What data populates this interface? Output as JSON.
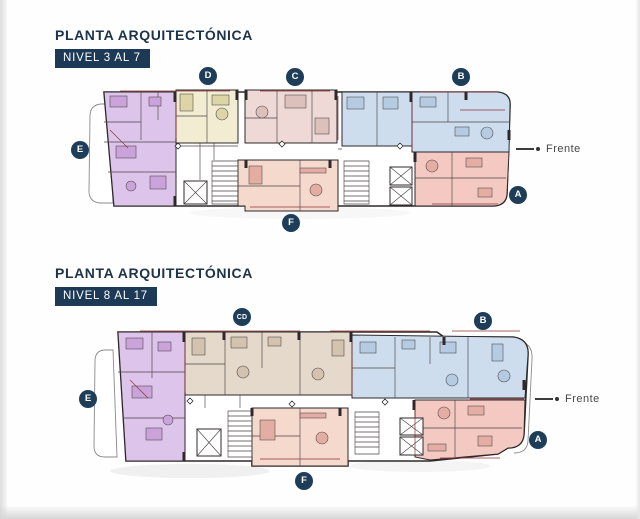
{
  "colors": {
    "navy": "#1c3a55",
    "badge_navy": "#1e3d58",
    "title_navy": "#1d3348",
    "unit_purple": "#ddc4ea",
    "unit_purple_dark": "#c9a3da",
    "unit_cream": "#f2edd2",
    "unit_cream_dark": "#ddd5a8",
    "unit_pink": "#eed9d6",
    "unit_pink_dark": "#dcc0bc",
    "unit_blue": "#cdddee",
    "unit_blue_dark": "#b4cbe2",
    "unit_salmon": "#f3c9c1",
    "unit_salmon2": "#f6d9cd",
    "unit_salmon_dark": "#e4ada4",
    "unit_beige": "#e5d9cb",
    "unit_beige_dark": "#d2c2ae",
    "wall": "#2e282b",
    "line": "#4a4446",
    "red_accent": "#8e3336",
    "outline_gray": "#8a8a8a"
  },
  "plan1": {
    "title": "PLANTA ARQUITECTÓNICA",
    "level": "NIVEL 3 AL 7",
    "frente_label": "Frente",
    "badges": {
      "d": "D",
      "c": "C",
      "b": "B",
      "e": "E",
      "a": "A",
      "f": "F"
    }
  },
  "plan2": {
    "title": "PLANTA ARQUITECTÓNICA",
    "level": "NIVEL 8 AL 17",
    "frente_label": "Frente",
    "badges": {
      "cd": "CD",
      "b": "B",
      "e": "E",
      "a": "A",
      "f": "F"
    }
  }
}
